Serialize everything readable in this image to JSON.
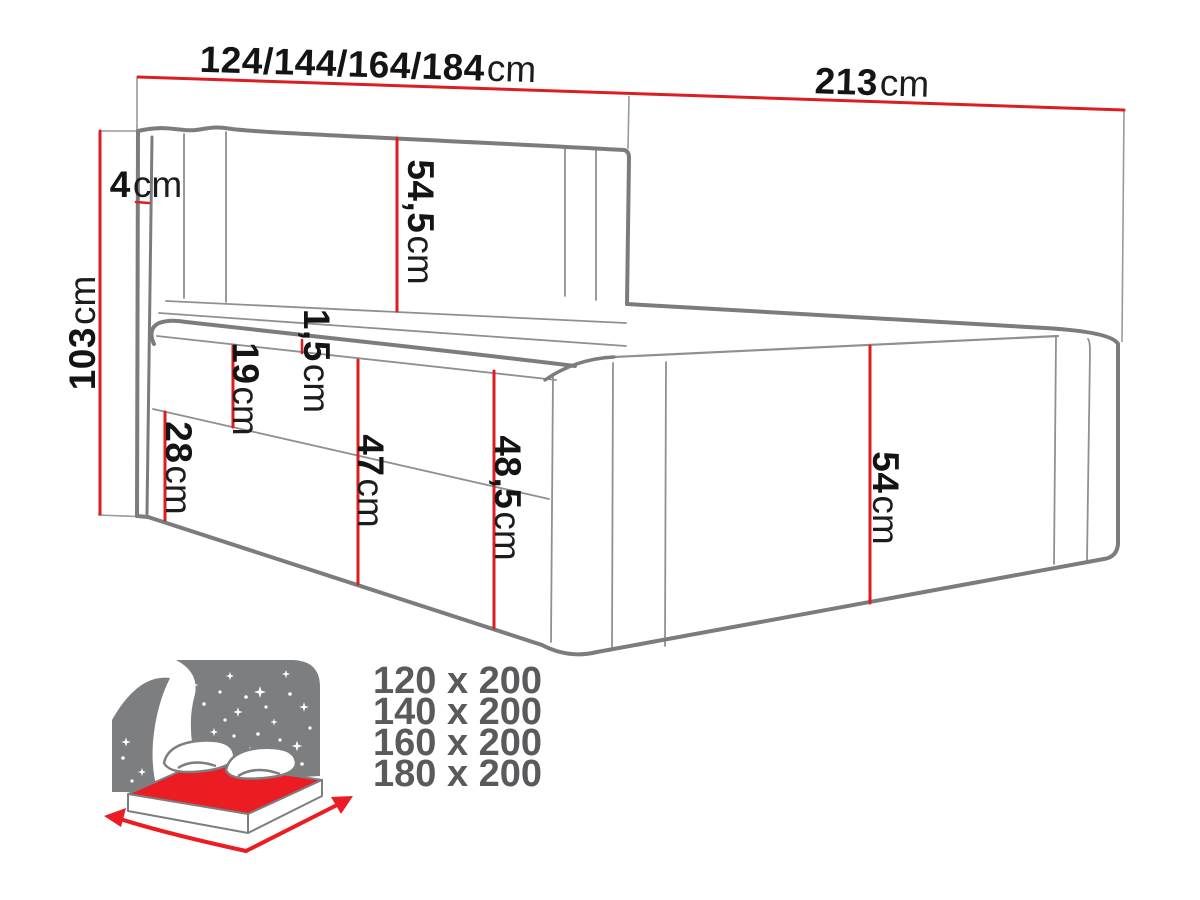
{
  "figure": {
    "type": "bed-dimension-diagram",
    "description": "Technical line drawing of an upholstered boxspring bed with red dimension lines"
  },
  "dimensions": {
    "width_options": {
      "value": "124/144/164/184",
      "unit": "cm"
    },
    "length_total": {
      "value": "213",
      "unit": "cm"
    },
    "height_total": {
      "value": "103",
      "unit": "cm"
    },
    "headboard_side": {
      "value": "4",
      "unit": "cm"
    },
    "headboard_above": {
      "value": "54,5",
      "unit": "cm"
    },
    "topper": {
      "value": "1,5",
      "unit": "cm"
    },
    "mattress": {
      "value": "19",
      "unit": "cm"
    },
    "base_front": {
      "value": "28",
      "unit": "cm"
    },
    "side_front": {
      "value": "47",
      "unit": "cm"
    },
    "side_corner": {
      "value": "48,5",
      "unit": "cm"
    },
    "foot_end": {
      "value": "54",
      "unit": "cm"
    }
  },
  "sizes": {
    "items": [
      "120 x 200",
      "140 x 200",
      "160 x 200",
      "180 x 200"
    ]
  },
  "icon": {
    "name": "bed-size-direction-icon"
  },
  "colors": {
    "dimension_red": "#dc1d21",
    "drawing_gray": "#7b7c7e",
    "text_black": "#141414",
    "sizes_gray": "#595a5c",
    "icon_red": "#ec1c23",
    "icon_gray": "#7d7e80"
  }
}
